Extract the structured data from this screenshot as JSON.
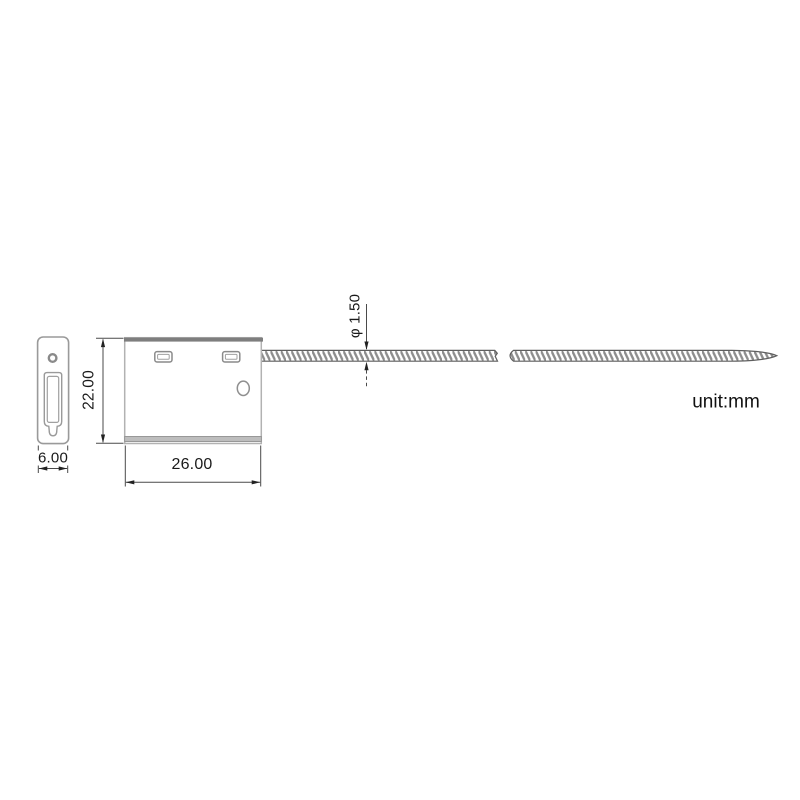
{
  "drawing": {
    "unit_label": "unit:mm",
    "dimensions": {
      "body_width_mm": "26.00",
      "body_height_mm": "22.00",
      "side_width_mm": "6.00",
      "cable_diameter_mm": "φ 1.50"
    },
    "colors": {
      "dimension_line": "#4a4a4a",
      "dimension_text": "#1a1a1a",
      "side_view_outline": "#9a9a9a",
      "body_outline": "#b2b2b2",
      "body_top_band": "#7e7e7e",
      "body_bottom_band": "#bdbdbd",
      "cable_edge": "#5f5f5f",
      "cable_hatch": "#8d8d8d",
      "background": "#ffffff"
    }
  }
}
